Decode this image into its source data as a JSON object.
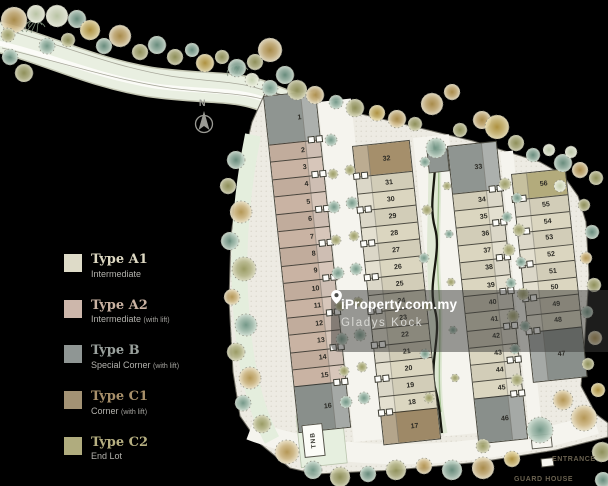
{
  "page": {
    "background": "#000000"
  },
  "legend": {
    "items": [
      {
        "label": "Type A1",
        "desc": "Intermediate",
        "note": "",
        "color": "#dedbc8",
        "text_color": "#ddd8c2"
      },
      {
        "label": "Type A2",
        "desc": "Intermediate",
        "note": "(with lift)",
        "color": "#cdb7ab",
        "text_color": "#c9b2a2"
      },
      {
        "label": "Type B",
        "desc": "Special Corner",
        "note": "(with lift)",
        "color": "#8f9694",
        "text_color": "#9aa19d"
      },
      {
        "label": "Type C1",
        "desc": "Corner",
        "note": "(with lift)",
        "color": "#a39274",
        "text_color": "#a8906a"
      },
      {
        "label": "Type C2",
        "desc": "End Lot",
        "note": "",
        "color": "#b0ac7e",
        "text_color": "#b6af81"
      }
    ]
  },
  "site": {
    "type_colors": {
      "A1": "#dbd6c0",
      "A2": "#c9b3a3",
      "B": "#8f9591",
      "C1": "#a58f6b",
      "C2": "#b3ab7c"
    },
    "rows": [
      {
        "name": "row-1",
        "units": [
          {
            "n": "1",
            "t": "B"
          },
          {
            "n": "2",
            "t": "A2"
          },
          {
            "n": "3",
            "t": "A2"
          },
          {
            "n": "4",
            "t": "A2"
          },
          {
            "n": "5",
            "t": "A2"
          },
          {
            "n": "6",
            "t": "A2"
          },
          {
            "n": "7",
            "t": "A2"
          },
          {
            "n": "8",
            "t": "A2"
          },
          {
            "n": "9",
            "t": "A2"
          },
          {
            "n": "10",
            "t": "A2"
          },
          {
            "n": "11",
            "t": "A2"
          },
          {
            "n": "12",
            "t": "A2"
          },
          {
            "n": "13",
            "t": "A2"
          },
          {
            "n": "14",
            "t": "A2"
          },
          {
            "n": "15",
            "t": "A2"
          },
          {
            "n": "16",
            "t": "B"
          }
        ]
      },
      {
        "name": "row-2",
        "units": [
          {
            "n": "32",
            "t": "C1"
          },
          {
            "n": "31",
            "t": "A1"
          },
          {
            "n": "30",
            "t": "A1"
          },
          {
            "n": "29",
            "t": "A1"
          },
          {
            "n": "28",
            "t": "A1"
          },
          {
            "n": "27",
            "t": "A1"
          },
          {
            "n": "26",
            "t": "A1"
          },
          {
            "n": "25",
            "t": "A1"
          },
          {
            "n": "24",
            "t": "A1"
          },
          {
            "n": "23",
            "t": "A1"
          },
          {
            "n": "22",
            "t": "A1"
          },
          {
            "n": "21",
            "t": "A1"
          },
          {
            "n": "20",
            "t": "A1"
          },
          {
            "n": "19",
            "t": "A1"
          },
          {
            "n": "18",
            "t": "A1"
          },
          {
            "n": "17",
            "t": "C1"
          }
        ]
      },
      {
        "name": "row-3",
        "units": [
          {
            "n": "33",
            "t": "B"
          },
          {
            "n": "34",
            "t": "A1"
          },
          {
            "n": "35",
            "t": "A1"
          },
          {
            "n": "36",
            "t": "A1"
          },
          {
            "n": "37",
            "t": "A1"
          },
          {
            "n": "38",
            "t": "A1"
          },
          {
            "n": "39",
            "t": "A1"
          },
          {
            "n": "40",
            "t": "A1"
          },
          {
            "n": "41",
            "t": "A1"
          },
          {
            "n": "42",
            "t": "A1"
          },
          {
            "n": "43",
            "t": "A1"
          },
          {
            "n": "44",
            "t": "A1"
          },
          {
            "n": "45",
            "t": "A1"
          },
          {
            "n": "46",
            "t": "B"
          }
        ]
      },
      {
        "name": "row-4",
        "units": [
          {
            "n": "56",
            "t": "C2"
          },
          {
            "n": "55",
            "t": "A1"
          },
          {
            "n": "54",
            "t": "A1"
          },
          {
            "n": "53",
            "t": "A1"
          },
          {
            "n": "52",
            "t": "A1"
          },
          {
            "n": "51",
            "t": "A1"
          },
          {
            "n": "50",
            "t": "A1"
          },
          {
            "n": "49",
            "t": "A1"
          },
          {
            "n": "48",
            "t": "A1"
          },
          {
            "n": "47",
            "t": "B"
          }
        ]
      }
    ]
  },
  "labels": {
    "north": "N",
    "tnb": "TNB",
    "entrance": "ENTRANCE",
    "guard_house": "GUARD HOUSE"
  },
  "watermark": {
    "brand": "iProperty.com.my",
    "agent": "Gladys Kock"
  }
}
